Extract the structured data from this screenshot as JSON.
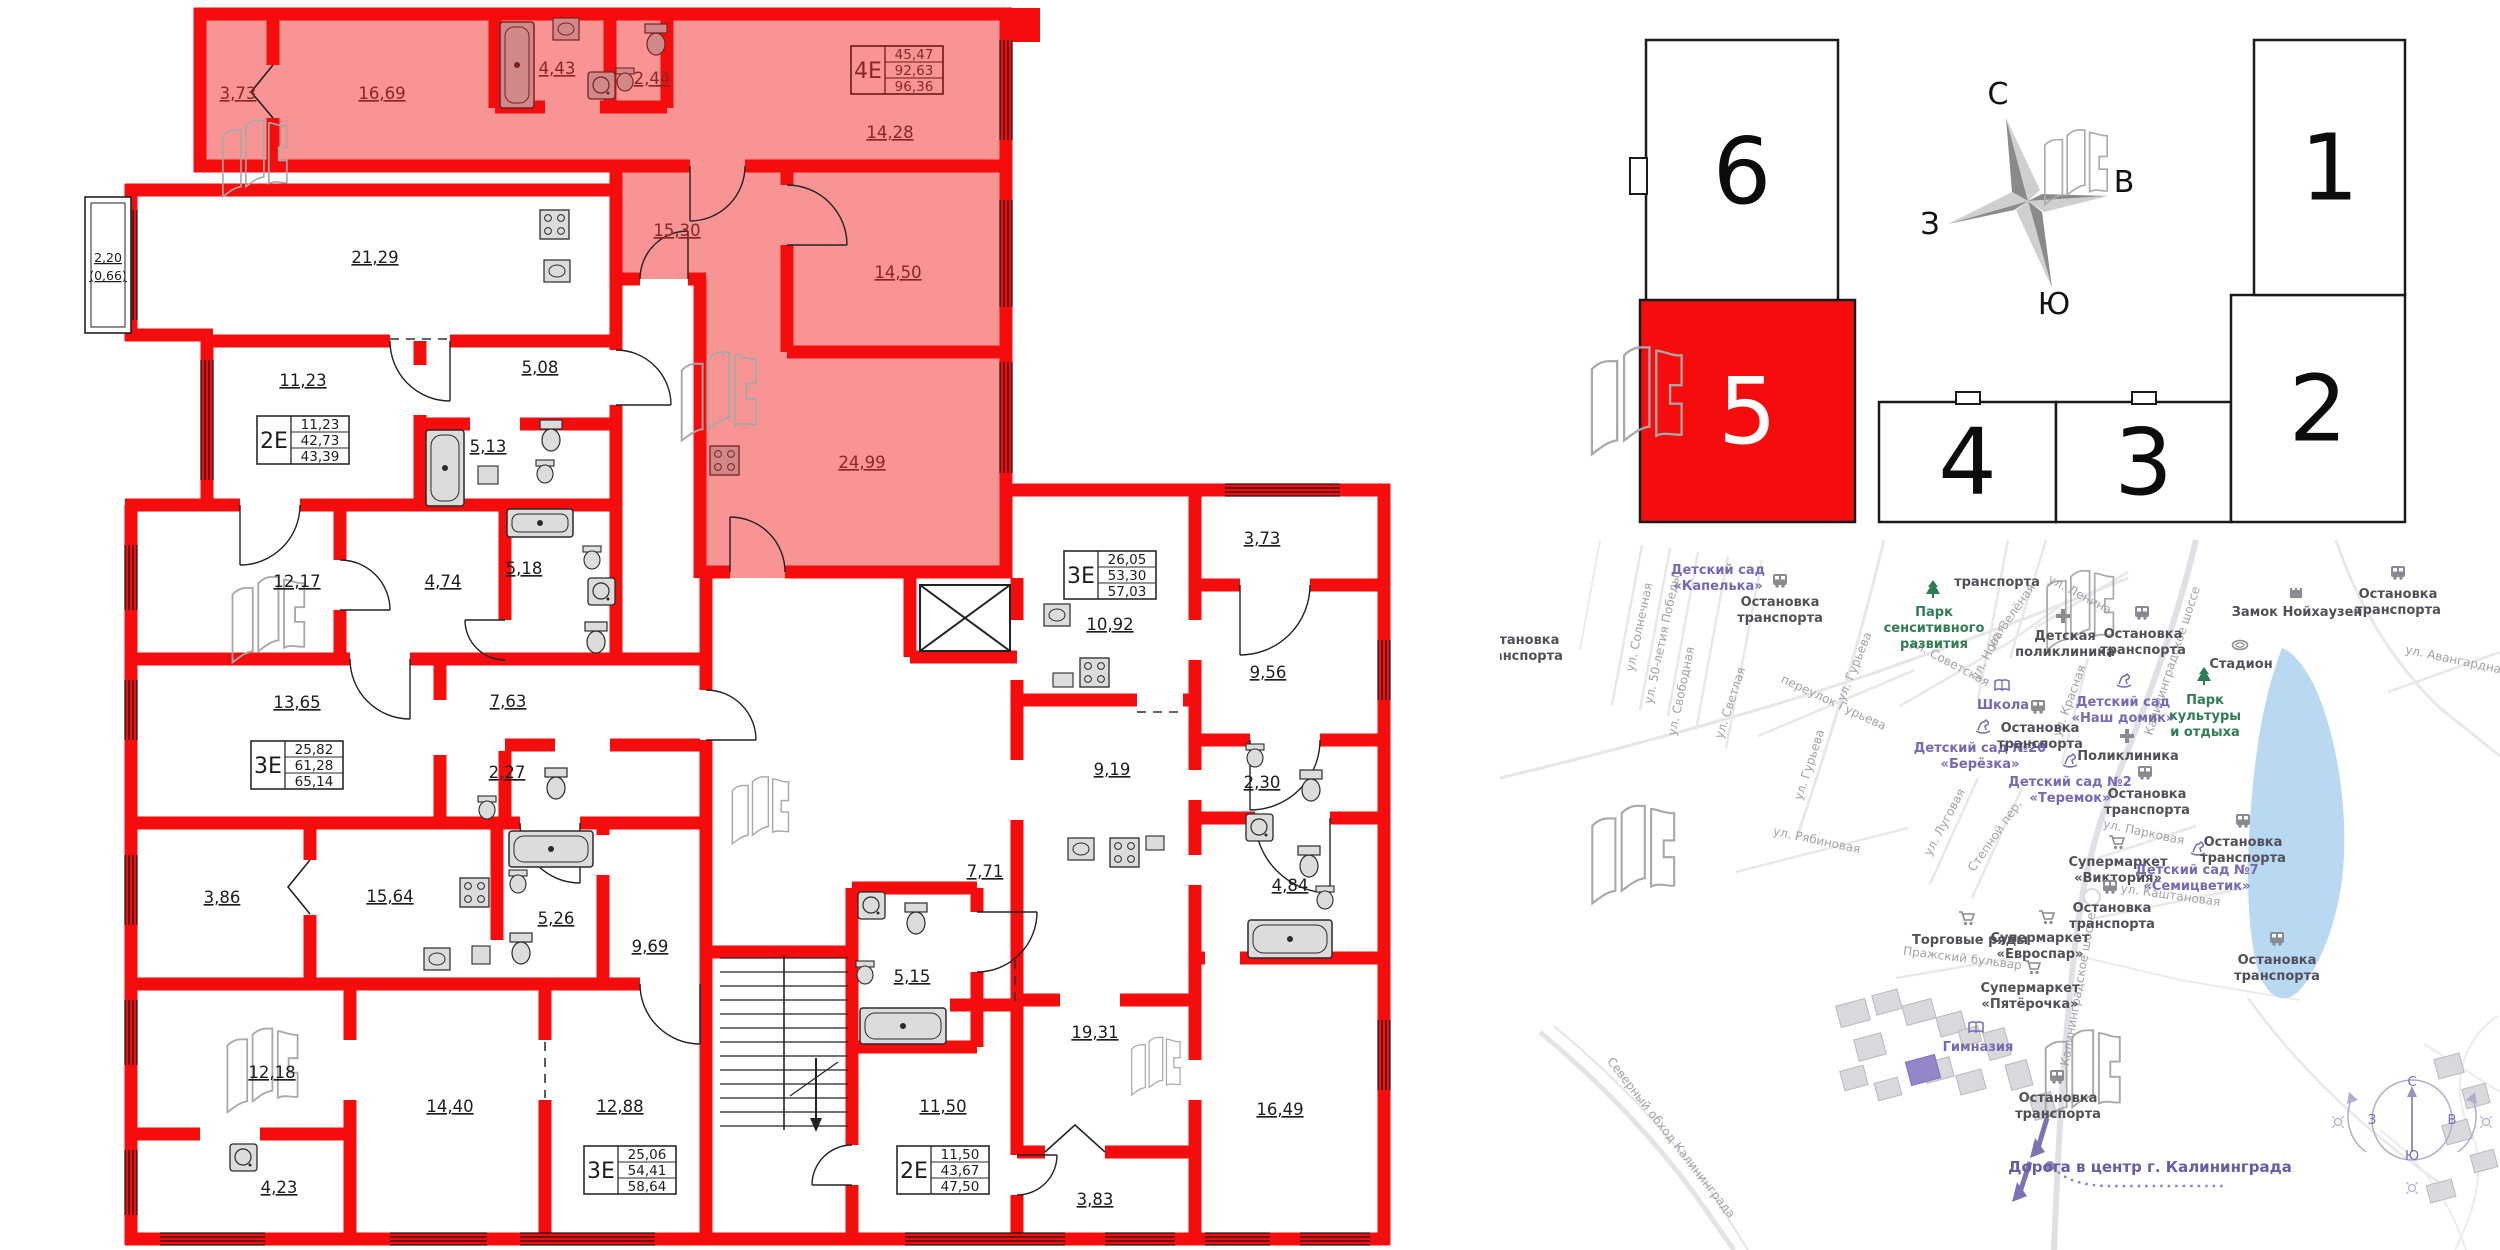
{
  "floorplan": {
    "balcony": {
      "line1": "2,20",
      "line2": "(0,66)"
    },
    "rooms": [
      {
        "label": "3,73",
        "x": 238,
        "y": 99,
        "zone": "pink"
      },
      {
        "label": "16,69",
        "x": 382,
        "y": 99,
        "zone": "pink"
      },
      {
        "label": "4,43",
        "x": 557,
        "y": 74,
        "zone": "pink"
      },
      {
        "label": "2,44",
        "x": 652,
        "y": 84,
        "zone": "pink"
      },
      {
        "label": "14,28",
        "x": 890,
        "y": 138,
        "zone": "pink"
      },
      {
        "label": "15,30",
        "x": 677,
        "y": 236,
        "zone": "pink"
      },
      {
        "label": "14,50",
        "x": 898,
        "y": 278,
        "zone": "pink"
      },
      {
        "label": "24,99",
        "x": 862,
        "y": 468,
        "zone": "pink"
      },
      {
        "label": "21,29",
        "x": 375,
        "y": 263
      },
      {
        "label": "11,23",
        "x": 303,
        "y": 386
      },
      {
        "label": "5,08",
        "x": 540,
        "y": 373
      },
      {
        "label": "5,13",
        "x": 488,
        "y": 452
      },
      {
        "label": "12,17",
        "x": 297,
        "y": 587
      },
      {
        "label": "4,74",
        "x": 443,
        "y": 587
      },
      {
        "label": "5,18",
        "x": 524,
        "y": 574
      },
      {
        "label": "13,65",
        "x": 297,
        "y": 708
      },
      {
        "label": "7,63",
        "x": 508,
        "y": 707
      },
      {
        "label": "2,27",
        "x": 507,
        "y": 778
      },
      {
        "label": "3,86",
        "x": 222,
        "y": 903
      },
      {
        "label": "15,64",
        "x": 390,
        "y": 902
      },
      {
        "label": "5,26",
        "x": 556,
        "y": 924
      },
      {
        "label": "9,69",
        "x": 650,
        "y": 952
      },
      {
        "label": "12,18",
        "x": 272,
        "y": 1078
      },
      {
        "label": "14,40",
        "x": 450,
        "y": 1112
      },
      {
        "label": "12,88",
        "x": 620,
        "y": 1112
      },
      {
        "label": "4,23",
        "x": 279,
        "y": 1193
      },
      {
        "label": "5,15",
        "x": 912,
        "y": 982
      },
      {
        "label": "11,50",
        "x": 943,
        "y": 1112
      },
      {
        "label": "7,71",
        "x": 985,
        "y": 877
      },
      {
        "label": "9,19",
        "x": 1112,
        "y": 775
      },
      {
        "label": "19,31",
        "x": 1095,
        "y": 1038
      },
      {
        "label": "3,83",
        "x": 1095,
        "y": 1205
      },
      {
        "label": "16,49",
        "x": 1280,
        "y": 1115
      },
      {
        "label": "10,92",
        "x": 1110,
        "y": 630
      },
      {
        "label": "3,73",
        "x": 1262,
        "y": 544
      },
      {
        "label": "9,56",
        "x": 1268,
        "y": 678
      },
      {
        "label": "2,30",
        "x": 1262,
        "y": 788
      },
      {
        "label": "4,84",
        "x": 1290,
        "y": 891
      }
    ],
    "tables": [
      {
        "type": "4Е",
        "values": [
          "45,47",
          "92,63",
          "96,36"
        ],
        "x": 897,
        "y": 70,
        "zone": "pink"
      },
      {
        "type": "2Е",
        "values": [
          "11,23",
          "42,73",
          "43,39"
        ],
        "x": 303,
        "y": 440
      },
      {
        "type": "3Е",
        "values": [
          "25,82",
          "61,28",
          "65,14"
        ],
        "x": 297,
        "y": 765
      },
      {
        "type": "3Е",
        "values": [
          "26,05",
          "53,30",
          "57,03"
        ],
        "x": 1110,
        "y": 575
      },
      {
        "type": "3Е",
        "values": [
          "25,06",
          "54,41",
          "58,64"
        ],
        "x": 630,
        "y": 1170
      },
      {
        "type": "2Е",
        "values": [
          "11,50",
          "43,67",
          "47,50"
        ],
        "x": 943,
        "y": 1170
      }
    ]
  },
  "building_diagram": {
    "blocks": [
      {
        "num": "6",
        "x": 1646,
        "y": 40,
        "w": 192,
        "h": 262,
        "highlighted": false
      },
      {
        "num": "5",
        "x": 1640,
        "y": 300,
        "w": 215,
        "h": 222,
        "highlighted": true
      },
      {
        "num": "4",
        "x": 1879,
        "y": 402,
        "w": 177,
        "h": 120,
        "highlighted": false
      },
      {
        "num": "3",
        "x": 2056,
        "y": 402,
        "w": 175,
        "h": 120,
        "highlighted": false
      },
      {
        "num": "2",
        "x": 2231,
        "y": 295,
        "w": 174,
        "h": 227,
        "highlighted": false
      },
      {
        "num": "1",
        "x": 2254,
        "y": 40,
        "w": 151,
        "h": 255,
        "highlighted": false
      }
    ],
    "compass": {
      "n": "С",
      "e": "В",
      "s": "Ю",
      "w": "З"
    }
  },
  "map": {
    "pois": [
      {
        "lines": [
          "Детский сад",
          "«Капелька»"
        ],
        "x": 1718,
        "y": 574,
        "c": "purple"
      },
      {
        "lines": [
          "Остановка",
          "транспорта"
        ],
        "x": 1780,
        "y": 606,
        "c": "dark",
        "icon": {
          "t": "bus",
          "x": 1780,
          "y": 580
        }
      },
      {
        "lines": [
          "транспорта"
        ],
        "x": 1997,
        "y": 586,
        "c": "dark"
      },
      {
        "lines": [
          "Остановка",
          "транспорта"
        ],
        "x": 1520,
        "y": 644,
        "c": "dark"
      },
      {
        "lines": [
          "Парк",
          "сенситивного",
          "развития"
        ],
        "x": 1934,
        "y": 616,
        "c": "green",
        "icon": {
          "t": "tree",
          "x": 1933,
          "y": 589
        }
      },
      {
        "lines": [
          "Школа"
        ],
        "x": 2003,
        "y": 709,
        "c": "purple",
        "icon": {
          "t": "book",
          "x": 2002,
          "y": 686
        }
      },
      {
        "lines": [
          "Детский сад №20",
          "«Берёзка»"
        ],
        "x": 1980,
        "y": 752,
        "c": "purple",
        "icon": {
          "t": "horse",
          "x": 1983,
          "y": 726
        }
      },
      {
        "lines": [
          "Остановка",
          "транспорта"
        ],
        "x": 2040,
        "y": 732,
        "c": "dark",
        "icon": {
          "t": "bus",
          "x": 2038,
          "y": 706
        }
      },
      {
        "lines": [
          "Детская",
          "поликлиника"
        ],
        "x": 2065,
        "y": 640,
        "c": "dark",
        "icon": {
          "t": "cross",
          "x": 2063,
          "y": 616
        }
      },
      {
        "lines": [
          "Остановка",
          "транспорта"
        ],
        "x": 2143,
        "y": 638,
        "c": "dark",
        "icon": {
          "t": "bus",
          "x": 2142,
          "y": 612
        }
      },
      {
        "lines": [
          "Замок Нойхаузен"
        ],
        "x": 2297,
        "y": 616,
        "c": "dark",
        "icon": {
          "t": "castle",
          "x": 2296,
          "y": 592
        }
      },
      {
        "lines": [
          "Остановка",
          "транспорта"
        ],
        "x": 2398,
        "y": 598,
        "c": "dark",
        "icon": {
          "t": "bus",
          "x": 2398,
          "y": 572
        }
      },
      {
        "lines": [
          "Стадион"
        ],
        "x": 2241,
        "y": 668,
        "c": "dark",
        "icon": {
          "t": "stadium",
          "x": 2240,
          "y": 645
        }
      },
      {
        "lines": [
          "Парк",
          "культуры",
          "и отдыха"
        ],
        "x": 2205,
        "y": 704,
        "c": "green",
        "icon": {
          "t": "tree",
          "x": 2204,
          "y": 676
        }
      },
      {
        "lines": [
          "Детский сад",
          "«Наш домик»"
        ],
        "x": 2123,
        "y": 706,
        "c": "purple",
        "icon": {
          "t": "horse",
          "x": 2124,
          "y": 680
        }
      },
      {
        "lines": [
          "Поликлиника"
        ],
        "x": 2128,
        "y": 760,
        "c": "dark",
        "icon": {
          "t": "cross",
          "x": 2127,
          "y": 736
        }
      },
      {
        "lines": [
          "Детский сад №2",
          "«Теремок»"
        ],
        "x": 2070,
        "y": 786,
        "c": "purple",
        "icon": {
          "t": "horse",
          "x": 2070,
          "y": 760
        }
      },
      {
        "lines": [
          "Остановка",
          "транспорта"
        ],
        "x": 2147,
        "y": 798,
        "c": "dark",
        "icon": {
          "t": "bus",
          "x": 2145,
          "y": 772
        }
      },
      {
        "lines": [
          "Супермаркет",
          "«Виктория»"
        ],
        "x": 2118,
        "y": 866,
        "c": "dark",
        "icon": {
          "t": "cart",
          "x": 2117,
          "y": 842
        }
      },
      {
        "lines": [
          "Детский сад №7",
          "«Семицветик»"
        ],
        "x": 2197,
        "y": 874,
        "c": "purple",
        "icon": {
          "t": "horse",
          "x": 2198,
          "y": 848
        }
      },
      {
        "lines": [
          "Остановка",
          "транспорта"
        ],
        "x": 2243,
        "y": 846,
        "c": "dark",
        "icon": {
          "t": "bus",
          "x": 2243,
          "y": 820
        }
      },
      {
        "lines": [
          "Остановка",
          "транспорта"
        ],
        "x": 2112,
        "y": 912,
        "c": "dark",
        "icon": {
          "t": "bus",
          "x": 2110,
          "y": 886
        }
      },
      {
        "lines": [
          "Супермаркет",
          "«Евроспар»"
        ],
        "x": 2040,
        "y": 942,
        "c": "dark",
        "icon": {
          "t": "cart",
          "x": 2047,
          "y": 917
        }
      },
      {
        "lines": [
          "Супермаркет",
          "«Пятёрочка»"
        ],
        "x": 2030,
        "y": 992,
        "c": "dark",
        "icon": {
          "t": "cart",
          "x": 2033,
          "y": 967
        }
      },
      {
        "lines": [
          "Остановка",
          "транспорта"
        ],
        "x": 2277,
        "y": 964,
        "c": "dark",
        "icon": {
          "t": "bus",
          "x": 2277,
          "y": 938
        }
      },
      {
        "lines": [
          "Торговые ряды"
        ],
        "x": 1970,
        "y": 944,
        "c": "dark",
        "icon": {
          "t": "cart",
          "x": 1967,
          "y": 918
        }
      },
      {
        "lines": [
          "Гимназия"
        ],
        "x": 1978,
        "y": 1051,
        "c": "purple",
        "icon": {
          "t": "book",
          "x": 1976,
          "y": 1028
        }
      },
      {
        "lines": [
          "Остановка",
          "транспорта"
        ],
        "x": 2058,
        "y": 1102,
        "c": "dark",
        "icon": {
          "t": "bus",
          "x": 2057,
          "y": 1076
        }
      }
    ],
    "streets": [
      {
        "label": "ул. Солнечная",
        "x": 1643,
        "y": 628,
        "rot": -78
      },
      {
        "label": "ул. 50-летия Победы",
        "x": 1666,
        "y": 640,
        "rot": -78
      },
      {
        "label": "ул. Свободная",
        "x": 1685,
        "y": 692,
        "rot": -78
      },
      {
        "label": "ул. Светлая",
        "x": 1734,
        "y": 704,
        "rot": -72
      },
      {
        "label": "переулок Гурьева",
        "x": 1832,
        "y": 706,
        "rot": 25
      },
      {
        "label": "ул. Гурьева",
        "x": 1858,
        "y": 668,
        "rot": -68
      },
      {
        "label": "ул. Гурьева",
        "x": 1813,
        "y": 766,
        "rot": -72
      },
      {
        "label": "ул. Советская",
        "x": 1948,
        "y": 666,
        "rot": 28
      },
      {
        "label": "ул. Новая",
        "x": 1992,
        "y": 654,
        "rot": -62
      },
      {
        "label": "ул. Зелёная",
        "x": 2014,
        "y": 618,
        "rot": -55
      },
      {
        "label": "ул. Ленина",
        "x": 2078,
        "y": 598,
        "rot": 28
      },
      {
        "label": "Калининградское шоссе",
        "x": 2176,
        "y": 662,
        "rot": -72
      },
      {
        "label": "ул. Красная",
        "x": 2073,
        "y": 702,
        "rot": -70
      },
      {
        "label": "ул. Авангардная",
        "x": 2456,
        "y": 664,
        "rot": 12
      },
      {
        "label": "ул. Рябиновая",
        "x": 1816,
        "y": 844,
        "rot": 12
      },
      {
        "label": "ул. Луговая",
        "x": 1948,
        "y": 824,
        "rot": -62
      },
      {
        "label": "Степной пер.",
        "x": 1998,
        "y": 838,
        "rot": -55
      },
      {
        "label": "Пражский бульвар",
        "x": 1962,
        "y": 962,
        "rot": 7
      },
      {
        "label": "ул. Парковая",
        "x": 2143,
        "y": 836,
        "rot": 12
      },
      {
        "label": "ул. Каштановая",
        "x": 2170,
        "y": 899,
        "rot": 8
      },
      {
        "label": "Северный обход Калининграда",
        "x": 1668,
        "y": 1140,
        "rot": 52
      },
      {
        "label": "Калининградское шоссе",
        "x": 2082,
        "y": 990,
        "rot": -80
      }
    ],
    "road_note": "Дорога в центр г. Калининграда",
    "mini_compass": {
      "n": "С",
      "e": "В",
      "s": "Ю",
      "w": "З"
    }
  }
}
